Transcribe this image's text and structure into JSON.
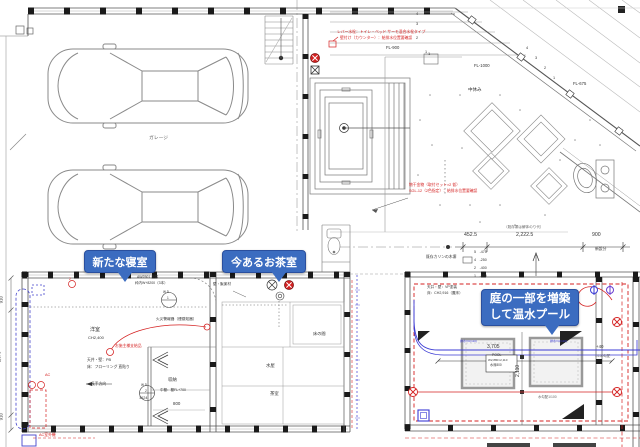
{
  "callouts": {
    "new_bedroom": "新たな寝室",
    "existing_tearoom": "今あるお茶室",
    "pool_line1": "庭の一部を増築",
    "pool_line2": "して温水プール"
  },
  "colors": {
    "callout": "#3b6cc0",
    "red": "#d42020",
    "pipe": "#3b3bd4",
    "valve": "#6a3fd0"
  },
  "annotations": [
    {
      "name": "note-lever-faucet-1",
      "text": "レバー水栓：トイレ・ベッド サーモ混合水栓タイプ",
      "x": 337,
      "y": 35,
      "size": 3.8,
      "color": "#d42020"
    },
    {
      "name": "note-lever-faucet-2",
      "text": "壁付け（カウンター）：給排水位置要確認",
      "x": 340,
      "y": 41,
      "size": 3.8,
      "color": "#d42020"
    },
    {
      "name": "level-fl900",
      "text": "FL-900",
      "x": 386,
      "y": 50,
      "size": 4.2
    },
    {
      "name": "grid-no-1",
      "text": "1",
      "x": 428,
      "y": 56,
      "size": 4
    },
    {
      "name": "level-fl1000",
      "text": "FL-1000",
      "x": 474,
      "y": 68,
      "size": 4.2
    },
    {
      "name": "label-nakayasumi",
      "text": "中休み",
      "x": 468,
      "y": 92,
      "size": 4.5
    },
    {
      "name": "level-fl675",
      "text": "FL-675",
      "x": 573,
      "y": 86,
      "size": 4.2
    },
    {
      "name": "room-garage",
      "text": "ガレージ",
      "x": 149,
      "y": 142,
      "size": 4.8,
      "color": "#666"
    },
    {
      "name": "step-5",
      "text": "5",
      "x": 478,
      "y": 2,
      "size": 3.8
    },
    {
      "name": "step-4a",
      "text": "4",
      "x": 416,
      "y": 17,
      "size": 3.8
    },
    {
      "name": "step-3a",
      "text": "3",
      "x": 416,
      "y": 27,
      "size": 3.8
    },
    {
      "name": "step-2a",
      "text": "2",
      "x": 416,
      "y": 41,
      "size": 3.8
    },
    {
      "name": "step-1a",
      "text": "1",
      "x": 425,
      "y": 55,
      "size": 3.8
    },
    {
      "name": "step-4b",
      "text": "4",
      "x": 526,
      "y": 51,
      "size": 3.8
    },
    {
      "name": "step-3b",
      "text": "3",
      "x": 535,
      "y": 61,
      "size": 3.8
    },
    {
      "name": "step-2b",
      "text": "2",
      "x": 544,
      "y": 71,
      "size": 3.8
    },
    {
      "name": "step-1b",
      "text": "1",
      "x": 553,
      "y": 81,
      "size": 3.8
    },
    {
      "name": "note-laundry-1",
      "text": "物干金物（取付セット×2 仮）",
      "x": 409,
      "y": 188,
      "size": 3.8,
      "color": "#d42020"
    },
    {
      "name": "note-laundry-2",
      "text": "SGL-12（2色指定）：給排水位置要確認",
      "x": 409,
      "y": 194,
      "size": 3.8,
      "color": "#d42020"
    },
    {
      "name": "note-demolition",
      "text": "（既存塀は解体のり代）",
      "x": 504,
      "y": 230,
      "size": 3.6,
      "color": "#666"
    },
    {
      "name": "dim-452-5",
      "text": "452.5",
      "x": 464,
      "y": 238,
      "size": 5.2
    },
    {
      "name": "dim-2222-5",
      "text": "2,222.5",
      "x": 516,
      "y": 238,
      "size": 5.2
    },
    {
      "name": "dim-900",
      "text": "900",
      "x": 592,
      "y": 238,
      "size": 5.2
    },
    {
      "name": "note-existing-fence",
      "text": "既存カリンの木塀",
      "x": 426,
      "y": 260,
      "size": 3.8
    },
    {
      "name": "note-shinsetsu",
      "text": "新設分",
      "x": 595,
      "y": 252,
      "size": 3.8
    },
    {
      "name": "step-level-5",
      "text": "5　-475",
      "x": 474,
      "y": 255,
      "size": 3.6
    },
    {
      "name": "step-level-4",
      "text": "4　-250",
      "x": 474,
      "y": 263,
      "size": 3.6
    },
    {
      "name": "step-level-2",
      "text": "2　-400",
      "x": 474,
      "y": 271,
      "size": 3.6
    },
    {
      "name": "step-level-1",
      "text": "1　-600",
      "x": 474,
      "y": 279,
      "size": 3.6
    },
    {
      "name": "note-pocket-1",
      "text": "AW2501 戸袋",
      "x": 137,
      "y": 279,
      "size": 3.5
    },
    {
      "name": "note-pocket-2",
      "text": "枠内W+8200（3本）",
      "x": 135,
      "y": 285,
      "size": 3.5
    },
    {
      "name": "room-bedroom",
      "text": "洋室",
      "x": 90,
      "y": 333,
      "size": 5
    },
    {
      "name": "room-bedroom-ch",
      "text": "CH2,400",
      "x": 88,
      "y": 340,
      "size": 4
    },
    {
      "name": "note-owner-supply",
      "text": "お施主様支給品",
      "x": 115,
      "y": 349,
      "size": 3.8,
      "color": "#d42020"
    },
    {
      "name": "note-ceiling",
      "text": "天井・壁：PB",
      "x": 87,
      "y": 363,
      "size": 3.8
    },
    {
      "name": "note-floor",
      "text": "床：フローリング 直貼り",
      "x": 87,
      "y": 370,
      "size": 3.8
    },
    {
      "name": "note-direction",
      "text": "長手方向",
      "x": 91,
      "y": 387,
      "size": 3.8
    },
    {
      "name": "note-fire-alarm",
      "text": "火災警報器（煙感知器）",
      "x": 156,
      "y": 322,
      "size": 3.7
    },
    {
      "name": "wd1-line1",
      "text": "W.D",
      "x": 163,
      "y": 294,
      "size": 3.2
    },
    {
      "name": "wd1-line2",
      "text": "1",
      "x": 167,
      "y": 300,
      "size": 3.2
    },
    {
      "name": "wd2-line1",
      "text": "W.D",
      "x": 141,
      "y": 387,
      "size": 3.2
    },
    {
      "name": "wd2-line2",
      "text": "2",
      "x": 145,
      "y": 393,
      "size": 3.2
    },
    {
      "name": "wd2-size",
      "text": "1624",
      "x": 139,
      "y": 401,
      "size": 3.8
    },
    {
      "name": "room-closet",
      "text": "収納",
      "x": 168,
      "y": 382,
      "size": 4.4
    },
    {
      "name": "note-shelf",
      "text": "中棚：棚FL+700",
      "x": 160,
      "y": 392,
      "size": 3.5
    },
    {
      "name": "dim-800",
      "text": "800",
      "x": 173,
      "y": 406,
      "size": 4.4
    },
    {
      "name": "dim-910-top",
      "text": "910",
      "x": 4,
      "y": 303,
      "size": 4.4,
      "rot": -90
    },
    {
      "name": "dim-1670",
      "text": "1,670",
      "x": 2,
      "y": 362,
      "size": 4.4,
      "rot": -90
    },
    {
      "name": "dim-910-bottom",
      "text": "910",
      "x": 4,
      "y": 420,
      "size": 4.4,
      "rot": -90
    },
    {
      "name": "note-ac",
      "text": "AC",
      "x": 45,
      "y": 378,
      "size": 3.8,
      "color": "#d42020"
    },
    {
      "name": "note-ac-outdoor",
      "text": "AC室外機",
      "x": 39,
      "y": 438,
      "size": 3.8,
      "color": "#d42020"
    },
    {
      "name": "note-wall-jyuraku",
      "text": "壁・聚楽材",
      "x": 213,
      "y": 287,
      "size": 3.6
    },
    {
      "name": "room-tokonoma",
      "text": "床の間",
      "x": 313,
      "y": 336,
      "size": 4.2
    },
    {
      "name": "room-mizuya",
      "text": "水屋",
      "x": 266,
      "y": 368,
      "size": 4.4
    },
    {
      "name": "room-chashitsu",
      "text": "茶室",
      "x": 270,
      "y": 396,
      "size": 4.4
    },
    {
      "name": "pool-box-1",
      "text": "POOL",
      "x": 492,
      "y": 357,
      "size": 3.4
    },
    {
      "name": "pool-box-2",
      "text": "W2,880×2,110",
      "x": 488,
      "y": 362,
      "size": 3
    },
    {
      "name": "pool-box-3",
      "text": "水深800",
      "x": 490,
      "y": 367,
      "size": 3.2
    },
    {
      "name": "dim-3705",
      "text": "3,705",
      "x": 487,
      "y": 350,
      "size": 5
    },
    {
      "name": "dim-plus40",
      "text": "+40",
      "x": 596,
      "y": 349,
      "size": 4.4
    },
    {
      "name": "note-slope-1",
      "text": "1/100勾配",
      "x": 595,
      "y": 358,
      "size": 3.4,
      "color": "#666"
    },
    {
      "name": "dim-2110",
      "text": "2,110",
      "x": 521,
      "y": 377,
      "size": 5,
      "rot": -90
    },
    {
      "name": "pipe-label-1",
      "text": "排水VU(110)",
      "x": 460,
      "y": 343,
      "size": 3,
      "color": "#3b3bd4"
    },
    {
      "name": "pipe-label-2",
      "text": "排水VU(110)",
      "x": 550,
      "y": 343,
      "size": 3,
      "color": "#3b3bd4"
    },
    {
      "name": "note-slope-2",
      "text": "水勾配1/100",
      "x": 538,
      "y": 399,
      "size": 3.4,
      "color": "#666"
    },
    {
      "name": "note-pool-ceiling",
      "text": "天井・壁：VP塗装",
      "x": 427,
      "y": 290,
      "size": 3.6
    },
    {
      "name": "note-pool-floor",
      "text": "床：CH2,916（置床）",
      "x": 427,
      "y": 296,
      "size": 3.6
    },
    {
      "name": "circled-2",
      "text": "2",
      "x": 69,
      "y": 281,
      "size": 3.2,
      "color": "#d42020"
    }
  ]
}
